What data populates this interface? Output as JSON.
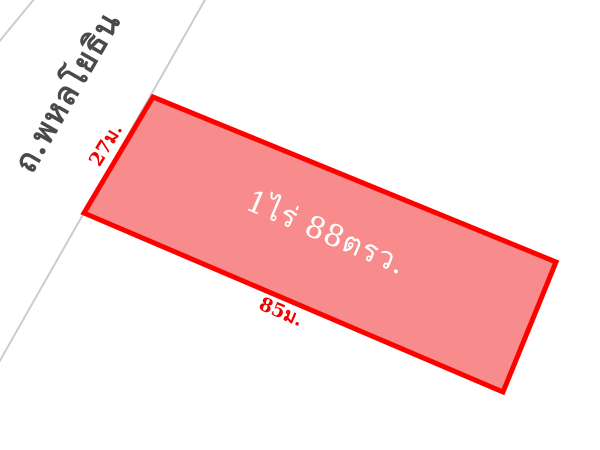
{
  "diagram": {
    "type": "land-plot-map",
    "background_color": "#ffffff"
  },
  "road": {
    "name_label": "ถ.พหลโยธิน",
    "line_color": "#cccccc",
    "label_color": "#4a4a4a"
  },
  "plot": {
    "area_label": "1ไร่ 88ตรว.",
    "fill_color": "#f88c8c",
    "border_color": "#ff0000",
    "area_label_color": "#ffffff",
    "dimensions": {
      "left_side_label": "27ม.",
      "bottom_side_label": "85ม.",
      "label_color": "#ee0000"
    }
  }
}
